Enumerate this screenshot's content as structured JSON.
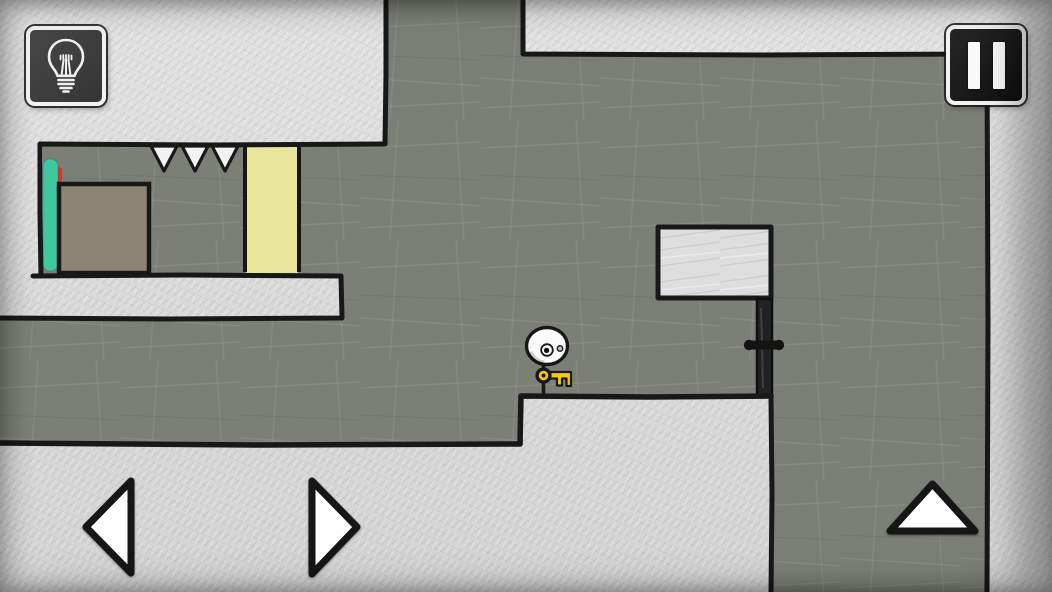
{
  "screen": {
    "kind": "hand-drawn physics puzzle platformer level",
    "visible_text": "none"
  },
  "hud": {
    "hint_button": {
      "icon": "lightbulb-icon",
      "label": "hint"
    },
    "pause_button": {
      "icon": "pause-icon",
      "label": "pause"
    }
  },
  "controls": {
    "left_button": {
      "icon": "triangle-left-icon",
      "label": "move left"
    },
    "right_button": {
      "icon": "triangle-right-icon",
      "label": "move right"
    },
    "jump_button": {
      "icon": "triangle-up-icon",
      "label": "jump"
    }
  },
  "level": {
    "player": {
      "description": "round white head with two eyes on a thin stick body",
      "x": 547,
      "y": 346,
      "standing_on": "ledge"
    },
    "key": {
      "description": "yellow key held by player",
      "x": 558,
      "y": 378
    },
    "locked_door": {
      "description": "dark vertical door with crossbar handle",
      "x": 764,
      "y": 348
    },
    "floating_block": {
      "description": "outlined white block above the door",
      "x": 715,
      "y": 262
    },
    "spikes": {
      "count": 3,
      "description": "white ceiling spikes",
      "x": 194,
      "y": 158
    },
    "teal_pad": {
      "description": "teal vertical pad on left wall",
      "x": 51,
      "y": 215
    },
    "red_strip": {
      "description": "red sliver behind teal pad",
      "x": 58,
      "y": 215
    },
    "crate": {
      "description": "brown square block",
      "x": 104,
      "y": 228
    },
    "yellow_door": {
      "description": "pale yellow floor-to-ceiling panel",
      "x": 272,
      "y": 210
    }
  },
  "colors": {
    "ink": "#181818",
    "field_gray": "#7c7f78",
    "paper_light": "#dedede",
    "teal": "#3fc8a0",
    "red": "#d23a2b",
    "crate_brown": "#8d8473",
    "door_yellow": "#e9e69b",
    "key_yellow": "#f6cb05",
    "spike_white": "#f2f2f2",
    "arrow_white": "#ffffff",
    "door_black": "#222222",
    "hud_border": "#f2f2f2"
  }
}
